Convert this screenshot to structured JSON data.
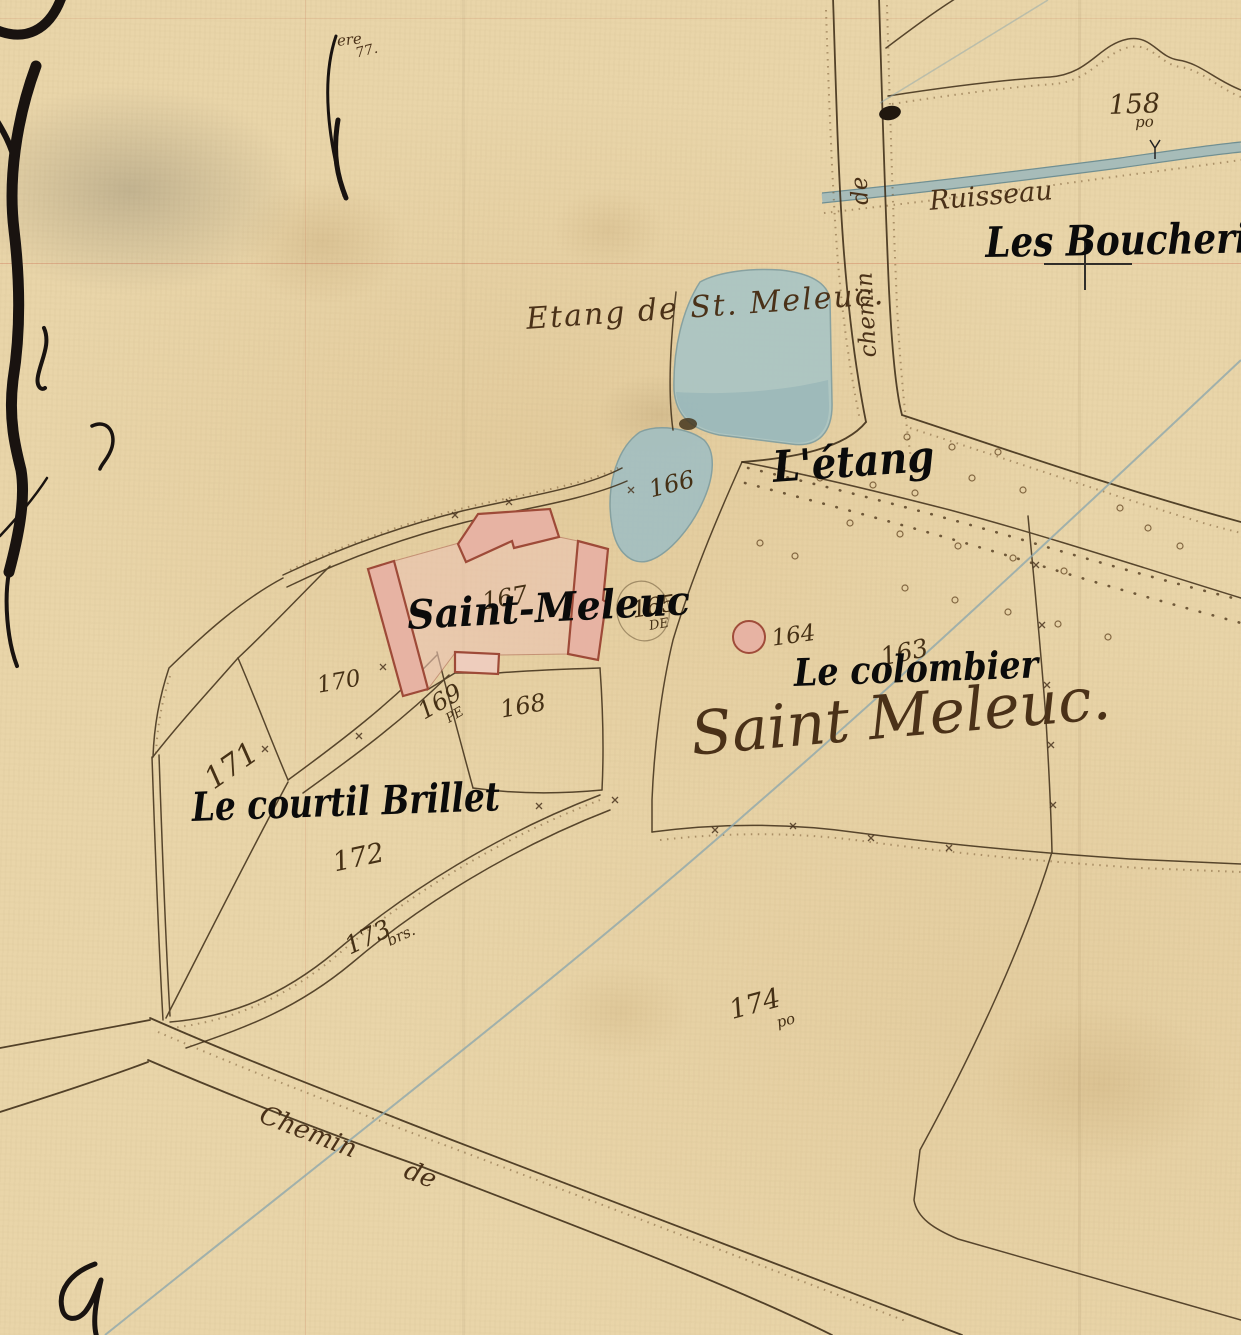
{
  "map": {
    "annotations": {
      "les_boucheries": "Les Boucheries",
      "letang": "L'étang",
      "saint_meleuc": "Saint-Meleuc",
      "le_colombier": "Le colombier",
      "le_courtil_brillet": "Le courtil Brillet"
    },
    "handwritten": {
      "etang": "Etang de St. Meleuc.",
      "ruisseau": "Ruisseau",
      "saint_meleuc_script": "Saint Meleuc.",
      "chemin_top": "chemin de",
      "chemin_bottom": "Chemin de",
      "note_line1": "ere",
      "note_line2": "77."
    },
    "parcels": [
      {
        "number": "158",
        "suffix": "po"
      },
      {
        "number": "163",
        "suffix": ""
      },
      {
        "number": "164",
        "suffix": ""
      },
      {
        "number": "165",
        "suffix": "DE"
      },
      {
        "number": "166",
        "suffix": ""
      },
      {
        "number": "167",
        "suffix": ""
      },
      {
        "number": "168",
        "suffix": ""
      },
      {
        "number": "169",
        "suffix": "PE"
      },
      {
        "number": "170",
        "suffix": ""
      },
      {
        "number": "171",
        "suffix": ""
      },
      {
        "number": "172",
        "suffix": ""
      },
      {
        "number": "173",
        "suffix": "brs."
      },
      {
        "number": "174",
        "suffix": "po"
      }
    ],
    "colors": {
      "paper": "#e9d5a9",
      "ink": "#3e2d17",
      "water": "#a9c5c5",
      "building_fill": "#e7b3a3",
      "building_outline": "#9e4a38",
      "survey_line": "#8ea7ad",
      "sheet_line": "#c15037",
      "annotation": "#0b0b0b",
      "handwriting": "#4a3118"
    }
  }
}
